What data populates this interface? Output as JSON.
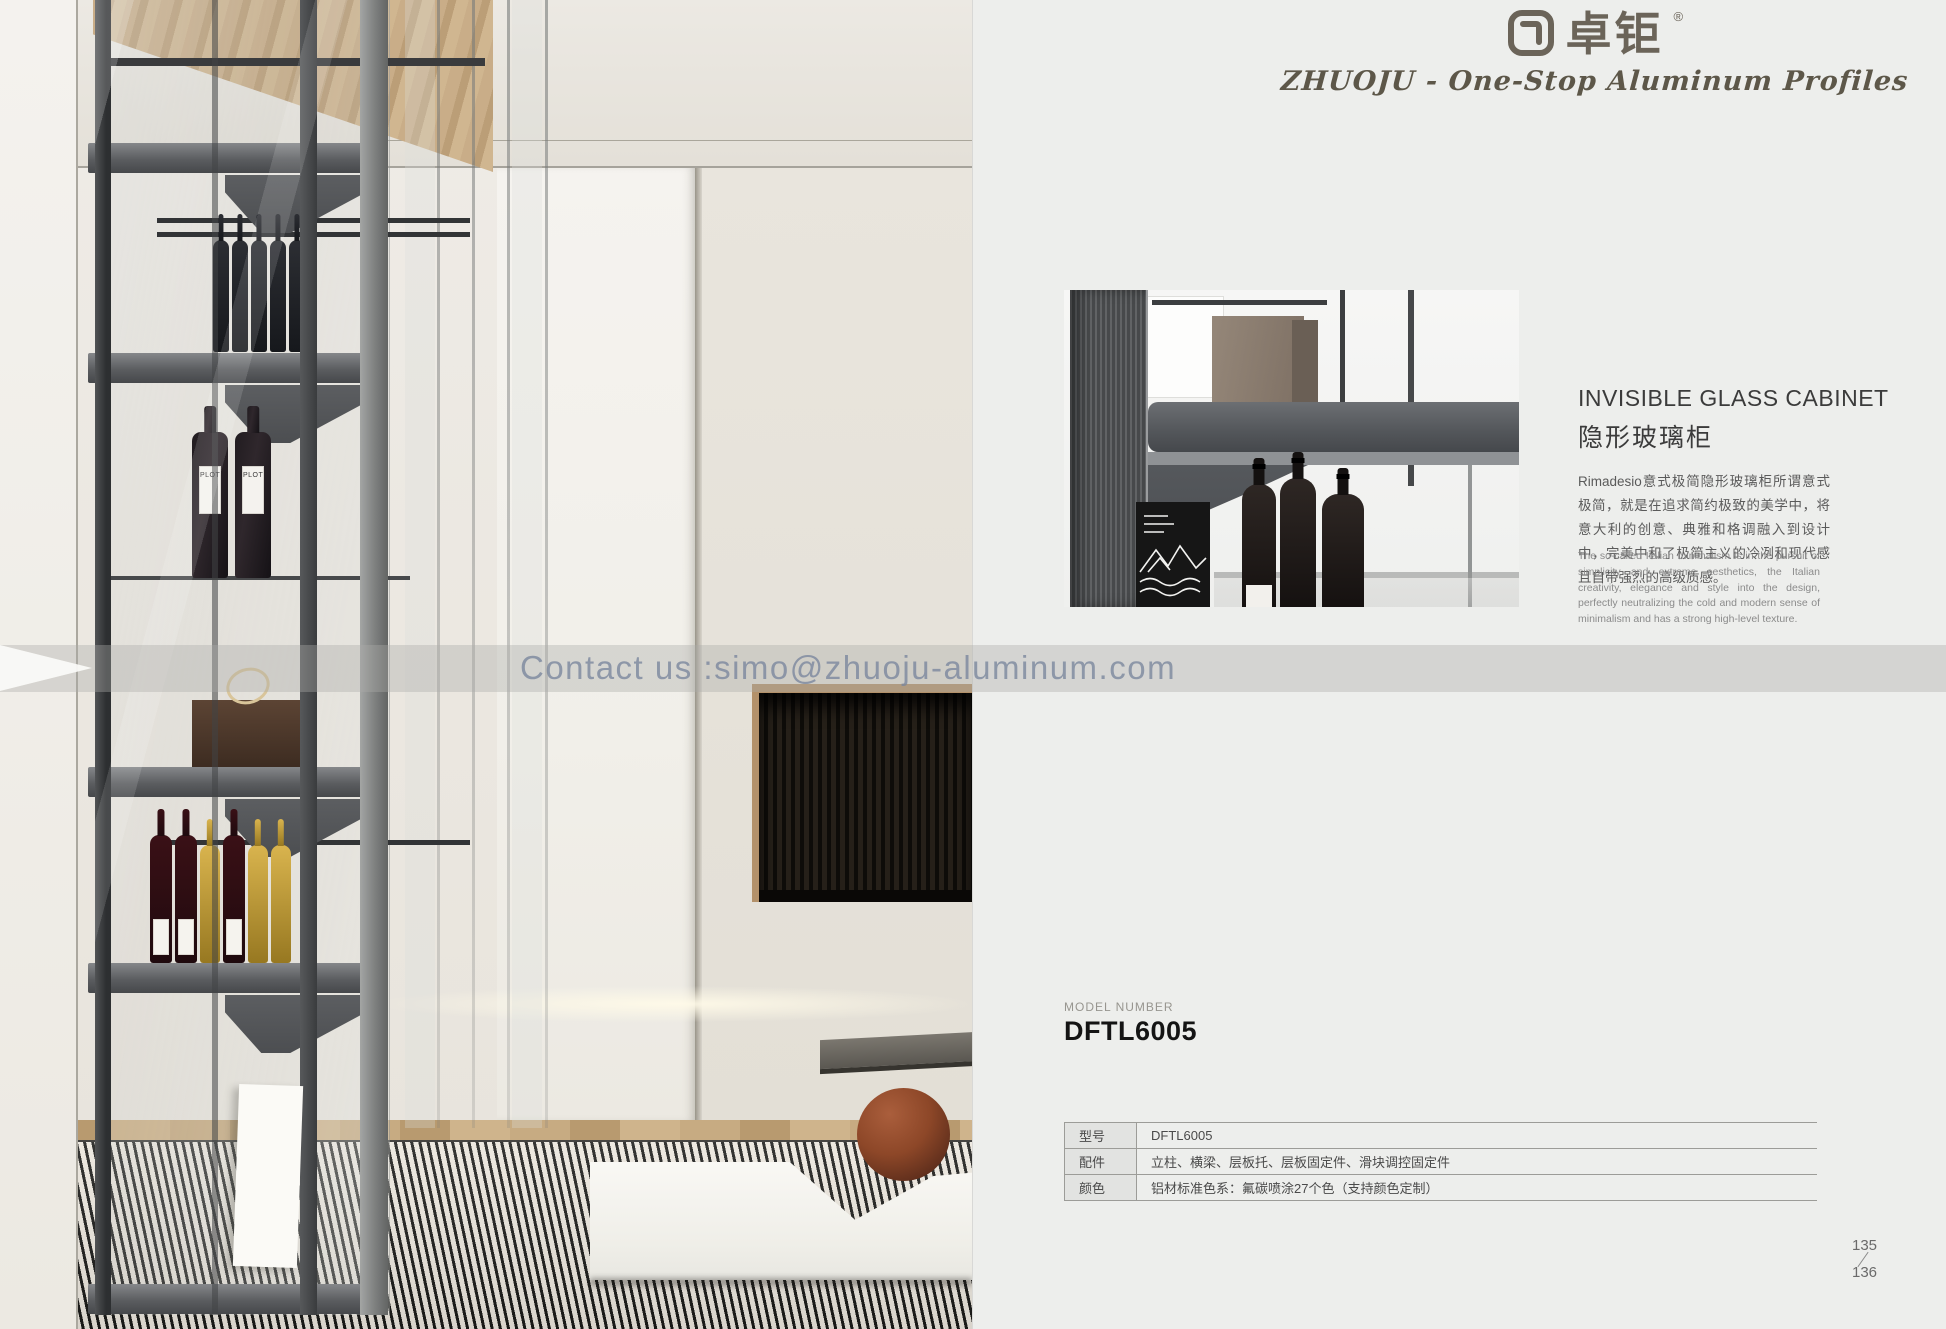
{
  "colors": {
    "page_bg": "#edeeec",
    "brand": "#6b6459",
    "table_border": "#9c9c98",
    "watermark_text": "#78859c"
  },
  "brand": {
    "logo_cn": "卓钜",
    "registered": "®",
    "tagline": "ZHUOJU - One-Stop Aluminum Profiles"
  },
  "product": {
    "title_en": "INVISIBLE GLASS CABINET",
    "title_cn": "隐形玻璃柜",
    "desc_cn": "Rimadesio意式极简隐形玻璃柜所谓意式极简，就是在追求简约极致的美学中，将意大利的创意、典雅和格调融入到设计中，完美中和了极简主义的冷冽和现代感且自带强烈的高级质感。",
    "desc_en": "The so-called Italian minimalism is in the pursuit of simplicity and extreme aesthetics, the Italian creativity, elegance and style into the design, perfectly neutralizing the cold and modern sense of minimalism and has a strong high-level texture."
  },
  "model": {
    "label": "MODEL NUMBER",
    "value": "DFTL6005"
  },
  "spec_table": {
    "rows": [
      {
        "label": "型号",
        "value": "DFTL6005"
      },
      {
        "label": "配件",
        "value": "立柱、横梁、层板托、层板固定件、滑块调控固定件"
      },
      {
        "label": "颜色",
        "value": "铝材标准色系：氟碳喷涂27个色（支持颜色定制）"
      }
    ]
  },
  "watermark": {
    "text": "Contact us :simo@zhuoju-aluminum.com"
  },
  "page_numbers": {
    "top": "135",
    "bottom": "136"
  },
  "photo": {
    "plot_label": "PLOT"
  }
}
